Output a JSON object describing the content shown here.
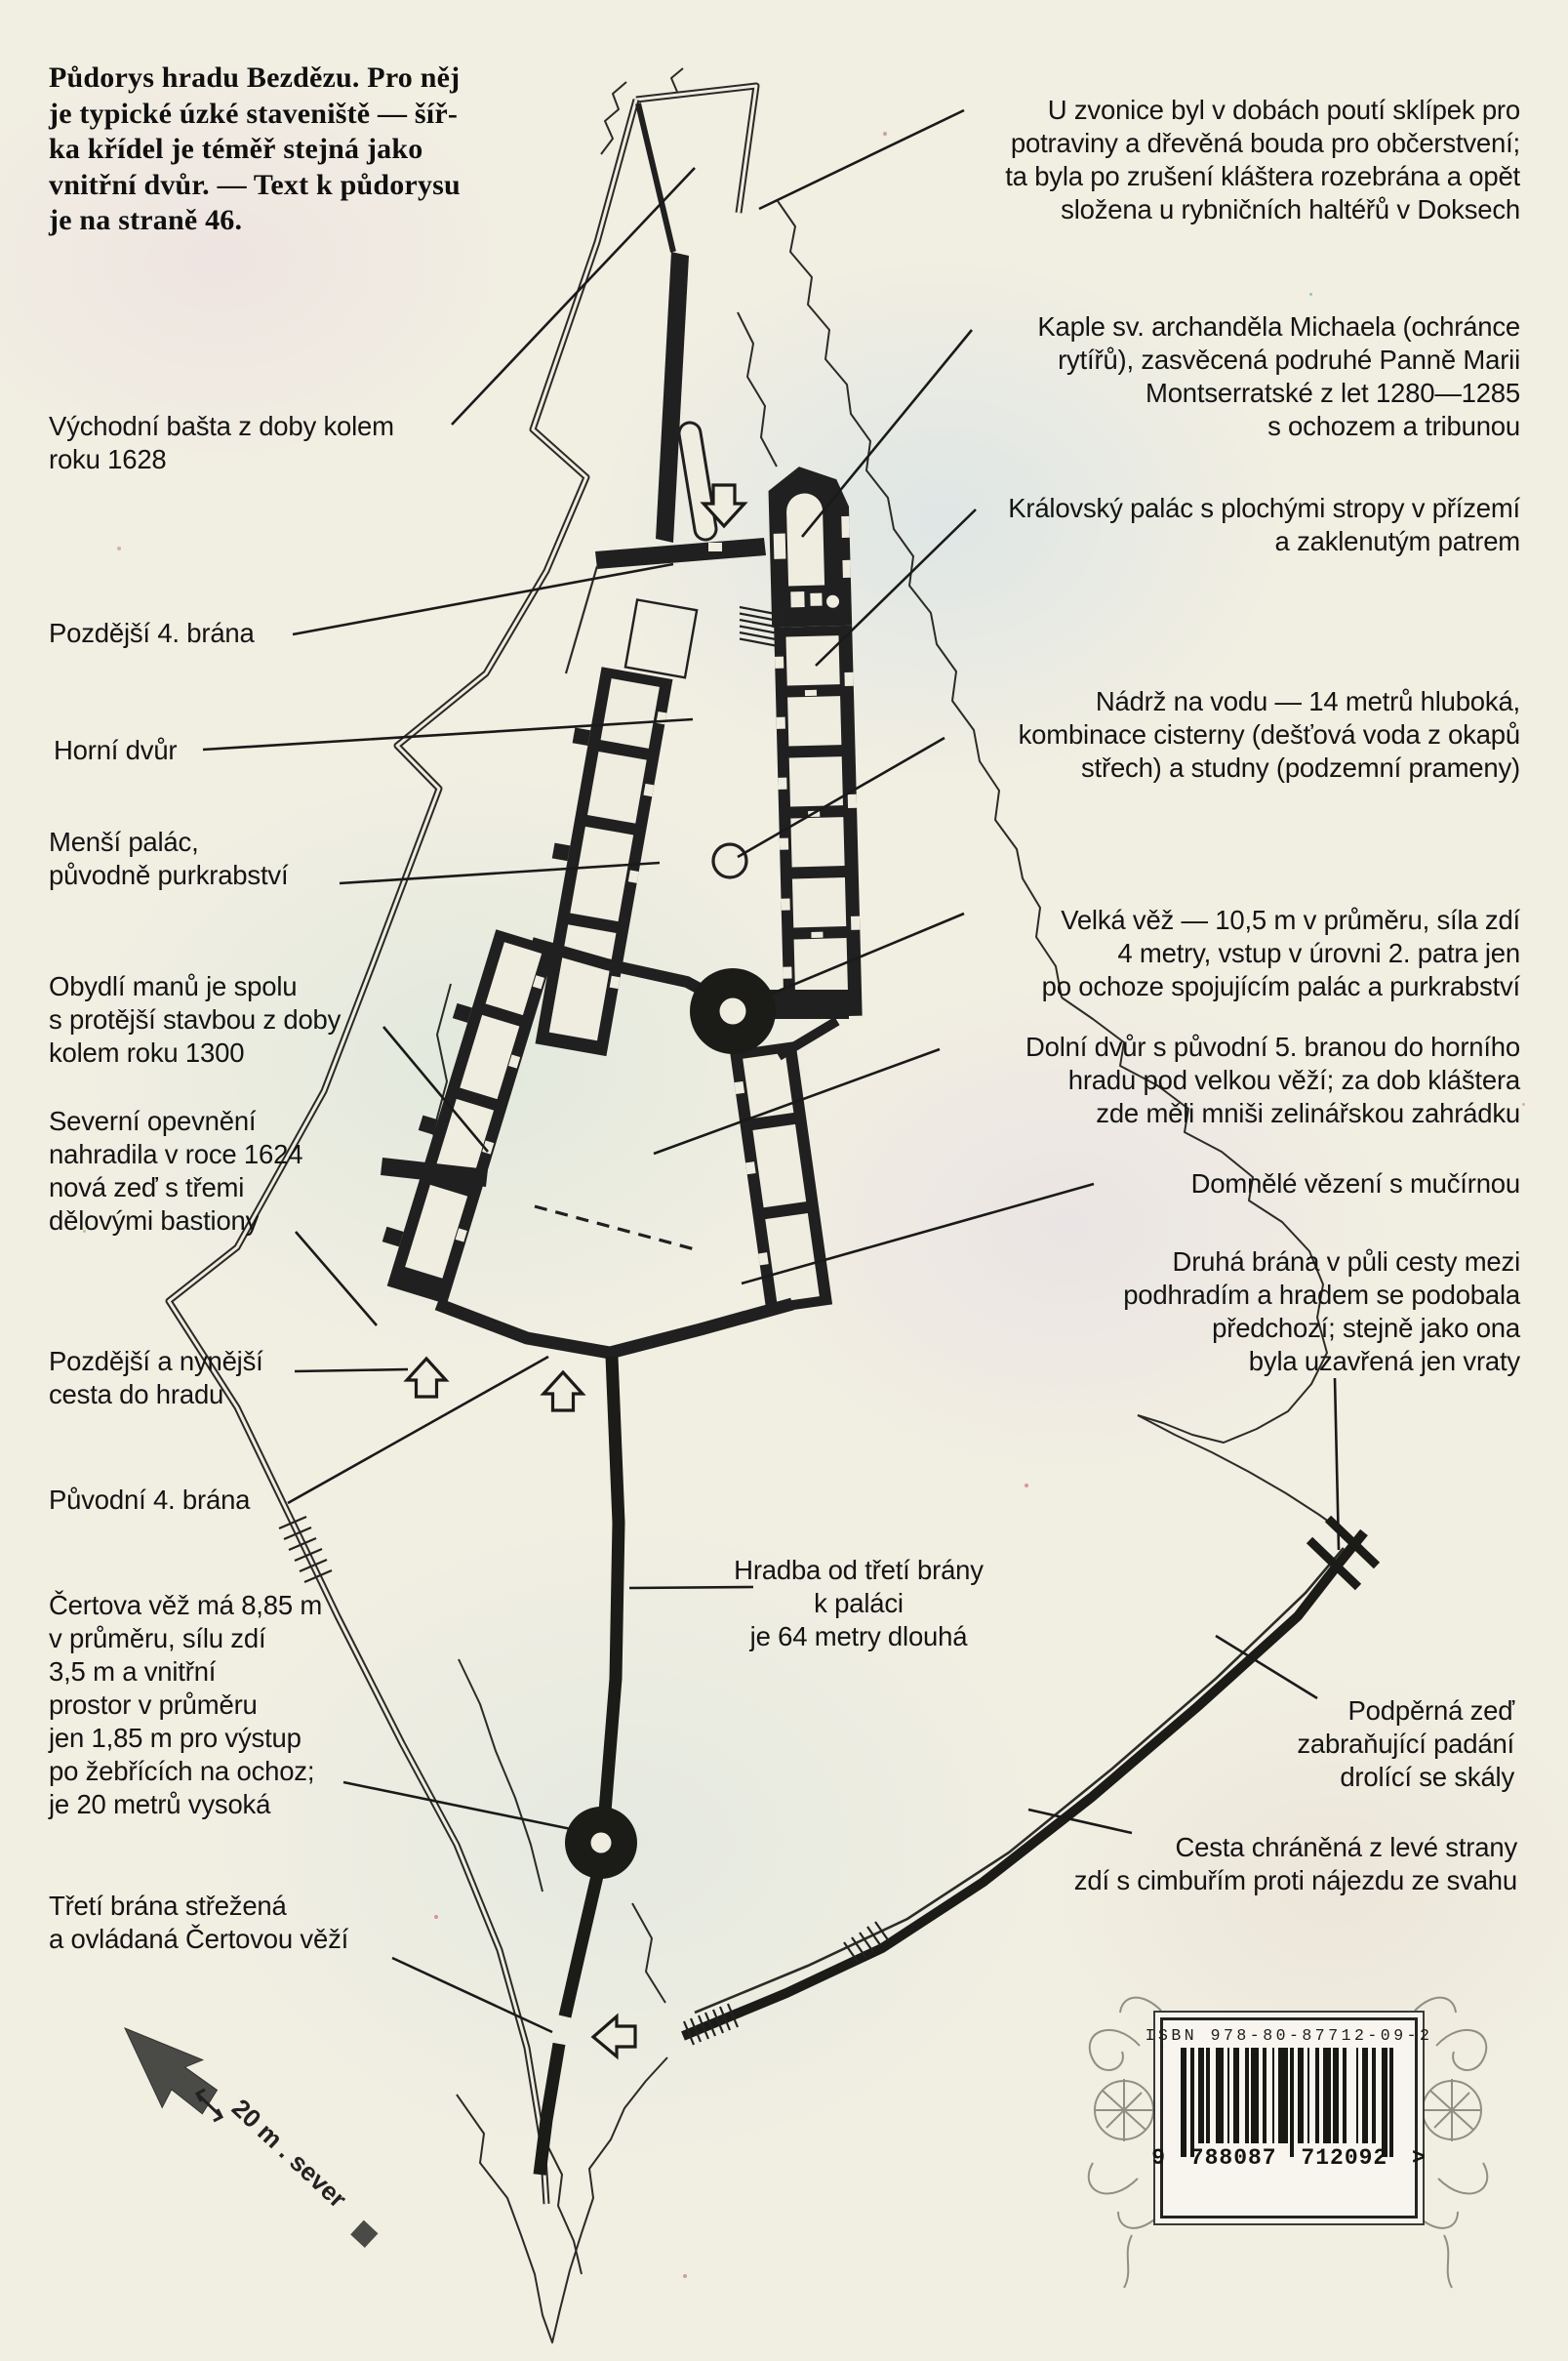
{
  "intro": {
    "text": "Půdorys hradu Bezdězu. Pro něj\nje typické úzké staveniště — šíř-\nka křídel je téměř stejná jako\nvnitřní dvůr. — Text k půdorysu\nje na straně 46."
  },
  "labels": {
    "vychodni_basta": "Východní bašta z doby kolem\nroku 1628",
    "pozdejsi_4_brana": "Pozdější 4. brána",
    "horni_dvur": "Horní dvůr",
    "mensi_palac": "Menší palác,\npůvodně purkrabství",
    "obydli_manu": "Obydlí manů je spolu\ns protější stavbou z doby\nkolem roku 1300",
    "severni_opevneni": "Severní opevnění\nnahradila v roce 1624\nnová zeď s třemi\ndělovými bastiony",
    "pozdejsi_cesta": "Pozdější a nynější\ncesta do hradu",
    "puvodni_4_brana": "Původní 4. brána",
    "certova_vez": "Čertova věž má 8,85 m\nv průměru, sílu zdí\n3,5 m a vnitřní\nprostor v průměru\njen 1,85 m pro výstup\npo žebřících na ochoz;\nje 20 metrů vysoká",
    "treti_brana": "Třetí brána střežená\na ovládaná Čertovou věží",
    "u_zvonice": "U zvonice byl v dobách poutí sklípek pro\npotraviny a dřevěná bouda pro občerstvení;\nta byla po zrušení kláštera rozebrána a opět\nsložena u rybničních haltéřů v Doksech",
    "kaple": "Kaple sv. archanděla Michaela (ochránce\nrytířů), zasvěcená podruhé Panně Marii\nMontserratské z let 1280—1285\ns ochozem a tribunou",
    "kralovsky_palac": "Královský palác s plochými stropy v přízemí\na zaklenutým patrem",
    "nadrz": "Nádrž na vodu — 14 metrů hluboká,\nkombinace cisterny (dešťová voda z okapů\nstřech) a studny (podzemní prameny)",
    "velka_vez": "Velká věž — 10,5 m v průměru, síla zdí\n4 metry, vstup v úrovni 2. patra jen\npo ochoze spojujícím palác a purkrabství",
    "dolni_dvur": "Dolní dvůr s původní 5. branou do horního\nhradu pod velkou věží; za dob kláštera\nzde měli mniši zelinářskou zahrádku",
    "domnele_vezeni": "Domnělé vězení s mučírnou",
    "druha_brana": "Druhá brána v půli cesty mezi\npodhradím a hradem se podobala\npředchozí; stejně jako ona\nbyla uzavřená jen vraty",
    "hradba": "Hradba od třetí brány\nk paláci\nje 64 metry dlouhá",
    "podperna_zed": "Podpěrná zeď\nzabraňující padání\ndrolící se skály",
    "cesta_chranena": "Cesta chráněná z levé strany\nzdí s cimbuřím proti nájezdu ze svahu"
  },
  "compass": {
    "scale_text": "20 m . sever"
  },
  "barcode": {
    "isbn": "ISBN 978-80-87712-09-2",
    "digits": "9 788087 712092 >"
  }
}
